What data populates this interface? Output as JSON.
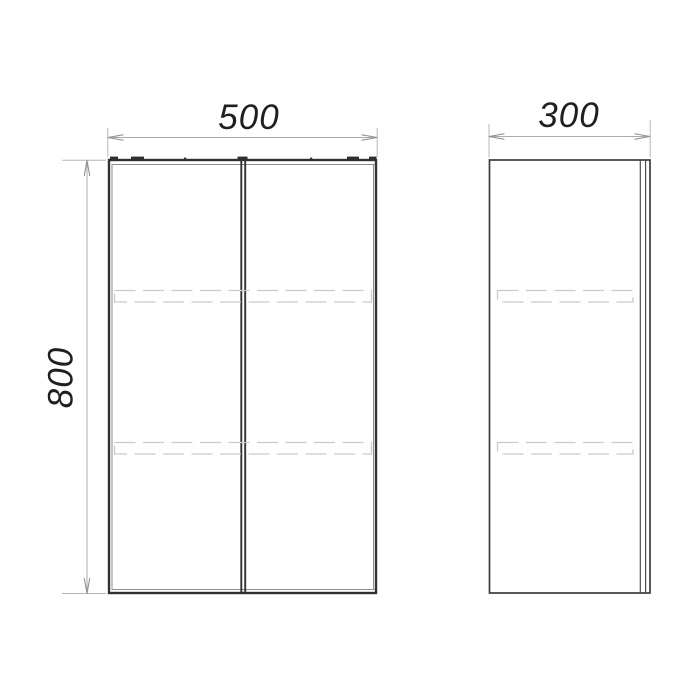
{
  "drawing": {
    "dimensions": {
      "width": "500",
      "depth": "300",
      "height": "800"
    }
  },
  "colors": {
    "background": "#ffffff",
    "main_outline": "#2f3234",
    "secondary_line": "#8a8e90",
    "dimension_line": "#a8acaf",
    "hidden_line": "#c7cbcc",
    "label_text": "#1d1f20"
  }
}
